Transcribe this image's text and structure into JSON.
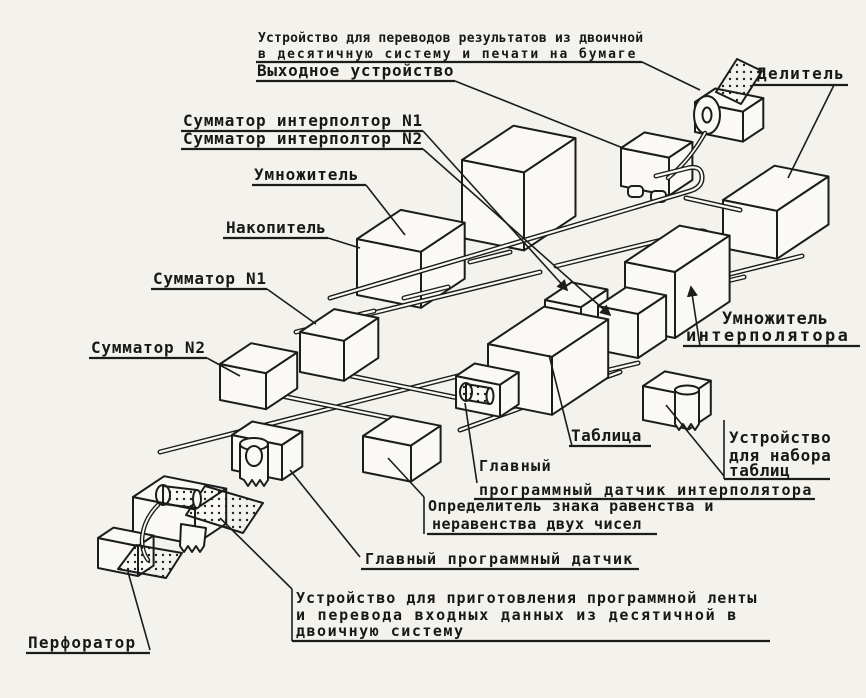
{
  "page": {
    "background": "#f3f2ed",
    "ink": "#1c1c1c",
    "kind": "scanned isometric machine schematic, Russian"
  },
  "diagram": {
    "labels": {
      "output_converter": {
        "line1": "Устройство для переводов результатов из двоичной",
        "line2": "в десятичную систему и печати на бумаге"
      },
      "output_device": {
        "text": "Выходное устройство"
      },
      "divider": {
        "text": "Делитель"
      },
      "adder_interpolator_n1": {
        "text": "Сумматор интерполтор N1"
      },
      "adder_interpolator_n2": {
        "text": "Сумматор интерполтор N2"
      },
      "multiplier": {
        "text": "Умножитель"
      },
      "accumulator": {
        "text": "Накопитель"
      },
      "adder_n1": {
        "text": "Сумматор N1"
      },
      "adder_n2": {
        "text": "Сумматор N2"
      },
      "interpolator_multiplier": {
        "line1": "Умножитель",
        "line2": "интерполятора"
      },
      "table": {
        "text": "Таблица"
      },
      "table_setting_device": {
        "line1": "Устройство",
        "line2": "для набора",
        "line3": "таблиц"
      },
      "main_program_sensor_interpolator": {
        "line1": "Главный",
        "line2": "программный датчик интерполятора"
      },
      "equality_sign_detector": {
        "line1": "Определитель знака равенства и",
        "line2": "неравенства двух чисел"
      },
      "main_program_sensor": {
        "text": "Главный программный датчик"
      },
      "input_converter": {
        "line1": "Устройство для приготовления программной ленты",
        "line2": "и перевода входных данных из десятичной в",
        "line3": "двоичную систему"
      },
      "perforator": {
        "text": "Перфоратор"
      }
    }
  }
}
